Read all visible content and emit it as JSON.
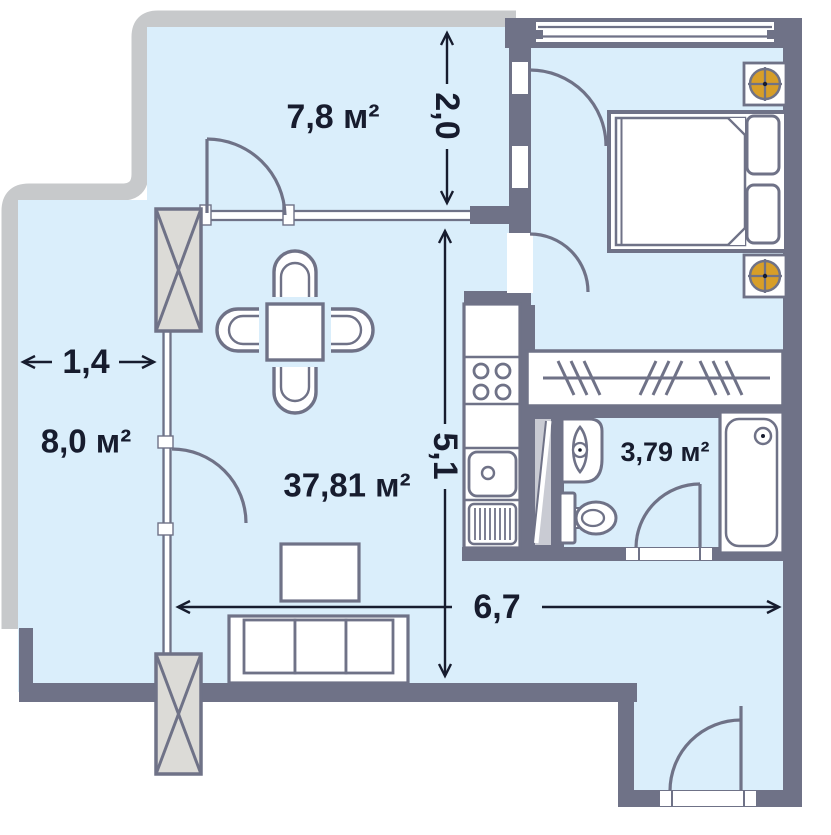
{
  "plan": {
    "type": "apartment-floor-plan",
    "rooms": [
      {
        "id": "loggia-top",
        "area_label": "7,8 м²"
      },
      {
        "id": "balcony-left",
        "area_label": "8,0 м²"
      },
      {
        "id": "living-room",
        "area_label": "37,81 м²"
      },
      {
        "id": "bathroom",
        "area_label": "3,79 м²"
      }
    ],
    "dimensions": [
      {
        "id": "loggia-depth",
        "value": "2,0",
        "orientation": "vertical"
      },
      {
        "id": "living-depth",
        "value": "5,1",
        "orientation": "vertical"
      },
      {
        "id": "balcony-width",
        "value": "1,4",
        "orientation": "horizontal"
      },
      {
        "id": "living-width",
        "value": "6,7",
        "orientation": "horizontal"
      }
    ],
    "furniture_icons": [
      "double-bed",
      "pillow",
      "ceiling-lamp",
      "wardrobe-rail-hangers",
      "dining-table",
      "chair",
      "tv-stand",
      "sofa-3-seat",
      "stove-4-burners",
      "kitchen-sink",
      "dish-drainer",
      "bath-sink",
      "toilet",
      "bathtub",
      "ventilation-column",
      "door-swing",
      "window",
      "utility-shaft"
    ],
    "colors": {
      "wall": "#6f7287",
      "floor": "#daeefb",
      "balcony_band": "#c7c9cb",
      "column_fill": "#dcdbd7",
      "accent_lamp": "#d79e28",
      "shaft_gray": "#c9cbd3",
      "ink": "#171c2e",
      "white": "#ffffff"
    }
  }
}
